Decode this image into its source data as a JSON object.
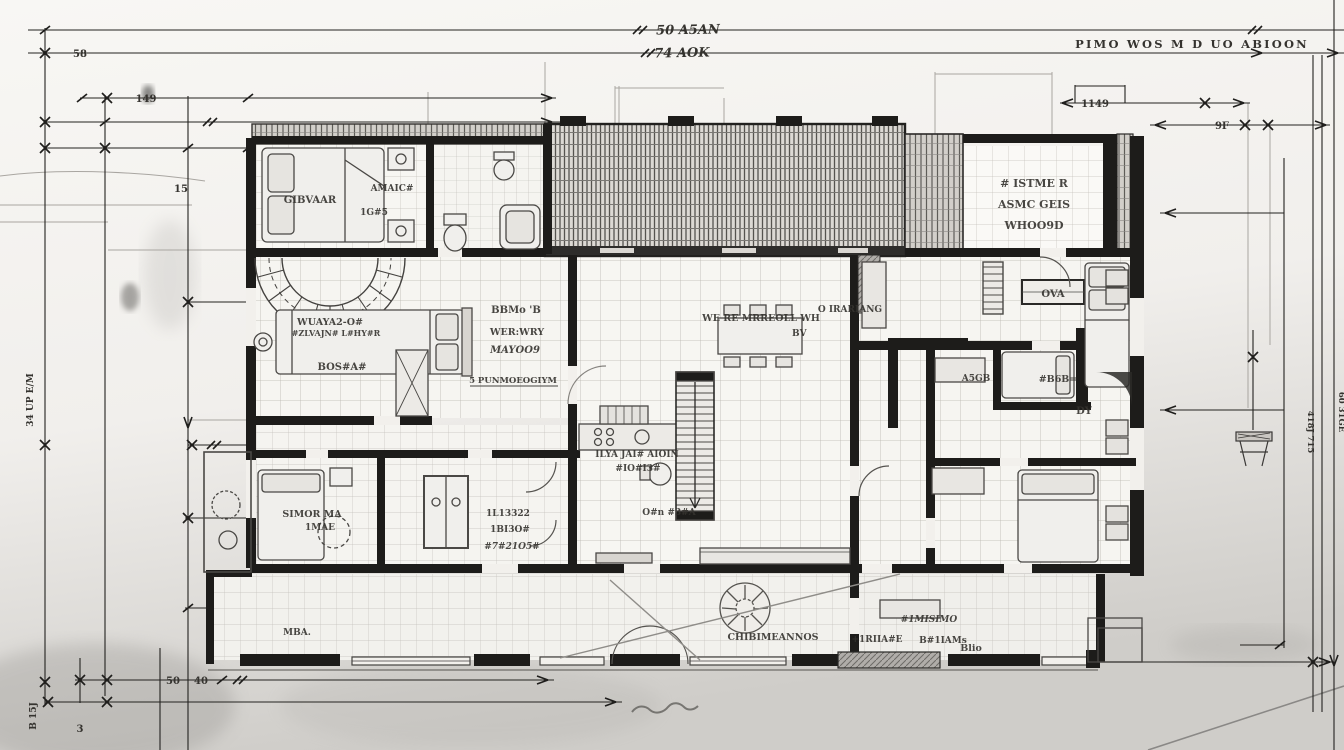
{
  "document": {
    "type": "hand-drawn architectural floor plan, pencil and ink on paper",
    "view": "ground floor plan with dimension chains"
  },
  "colors": {
    "paper_top": "#f8f7f4",
    "paper_bottom": "#cfcdc9",
    "ink": "#2a2927",
    "wall_fill": "#1d1c1a",
    "tile_grid": "#b9b6b0",
    "pencil_smudge": "#8f8d89",
    "hatch_dark": "#55534f"
  },
  "dims": {
    "top1": "50 A5AN",
    "top2": "74 AOK",
    "note": "PIMO WOS M D UO ABIOON",
    "n58": "58",
    "n140": "149",
    "n15": "15",
    "n1149": "1149",
    "n9f": "9F",
    "n50": "50",
    "n40": "40",
    "lv1": "34 UP E/M",
    "lv2": "B 15J",
    "lv3": "3",
    "rv1": "418J 715",
    "rv2": "60 31GE"
  },
  "rooms": {
    "tl": "GIBVAAR",
    "tm1": "AMAIC#",
    "tm2": "1G#5",
    "tr1": "# ISTME R",
    "tr2": "ASMC GEIS",
    "tr3": "WHOO9D",
    "mb1": "WUAYA2-O#",
    "mb2": "#ZLVAJN# L#HY#R",
    "mb3": "BOS#A#",
    "c1": "BBMo 'B",
    "c2": "WER:WRY",
    "c3": "MAYOO9",
    "c4": "5 PUNMOEOGIYM",
    "cr1": "WE RE MRREOLL WH",
    "cr2": "BV",
    "cr3": "O IRARIANG",
    "k1": "ILYA JAI# AIOIN",
    "k2": "#IO#I3#",
    "k3": "O#n #3#A",
    "lb1": "SIMOR MA",
    "lb2": "1MAE",
    "cl1": "1L13322",
    "cl2": "1BI3O#",
    "cl3": "#7#21O5#",
    "bt": "CHIBIMEANNOS",
    "br1": "#1MISIMO",
    "br2": "+1RIIA#E",
    "br3": "B#1IAMs",
    "bl": "MBA.",
    "ova": "OVA",
    "dy": "DY",
    "g45": "A5GB",
    "rm": "#B6B=",
    "blio": "Blio"
  }
}
